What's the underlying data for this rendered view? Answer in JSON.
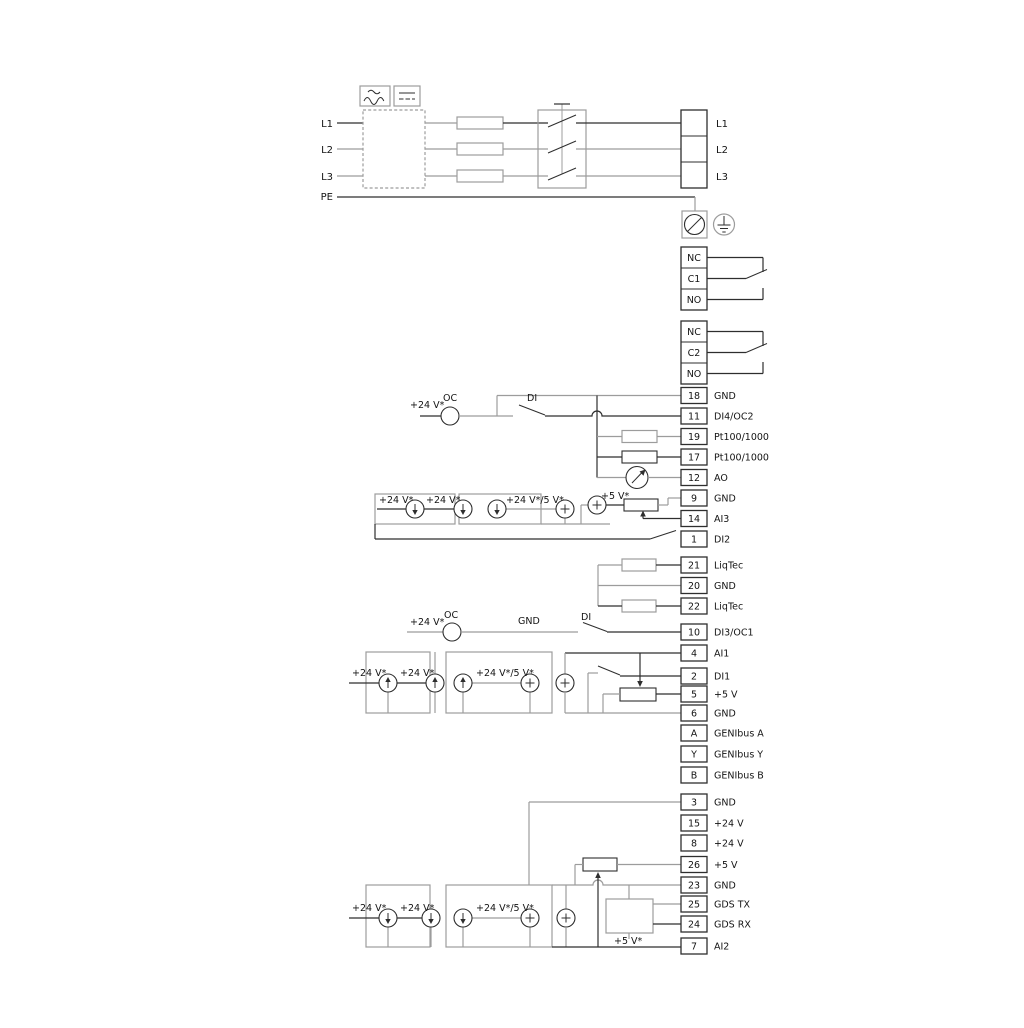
{
  "title": "Frequency converter power and control terminal wiring diagram",
  "colors": {
    "background": "#ffffff",
    "wire_dark": "#2e2e2e",
    "wire_gray": "#9c9c9c",
    "text": "#141414"
  },
  "power_in": {
    "l1": "L1",
    "l2": "L2",
    "l3": "L3",
    "pe": "PE"
  },
  "power_out": {
    "l1": "L1",
    "l2": "L2",
    "l3": "L3"
  },
  "relay1": {
    "nc": "NC",
    "c": "C1",
    "no": "NO"
  },
  "relay2": {
    "nc": "NC",
    "c": "C2",
    "no": "NO"
  },
  "rows": {
    "t18": {
      "n": "18",
      "l": "GND"
    },
    "t11": {
      "n": "11",
      "l": "DI4/OC2"
    },
    "t19": {
      "n": "19",
      "l": "Pt100/1000"
    },
    "t17": {
      "n": "17",
      "l": "Pt100/1000"
    },
    "t12": {
      "n": "12",
      "l": "AO"
    },
    "t9": {
      "n": "9",
      "l": "GND"
    },
    "t14": {
      "n": "14",
      "l": "AI3"
    },
    "t1": {
      "n": "1",
      "l": "DI2"
    },
    "t21": {
      "n": "21",
      "l": "LiqTec"
    },
    "t20": {
      "n": "20",
      "l": "GND"
    },
    "t22": {
      "n": "22",
      "l": "LiqTec"
    },
    "t10": {
      "n": "10",
      "l": "DI3/OC1"
    },
    "t4": {
      "n": "4",
      "l": "AI1"
    },
    "t2": {
      "n": "2",
      "l": "DI1"
    },
    "t5": {
      "n": "5",
      "l": "+5 V"
    },
    "t6": {
      "n": "6",
      "l": "GND"
    },
    "tA": {
      "n": "A",
      "l": "GENIbus A"
    },
    "tY": {
      "n": "Y",
      "l": "GENIbus Y"
    },
    "tB": {
      "n": "B",
      "l": "GENIbus B"
    },
    "t3": {
      "n": "3",
      "l": "GND"
    },
    "t15": {
      "n": "15",
      "l": "+24 V"
    },
    "t8": {
      "n": "8",
      "l": "+24 V"
    },
    "t26": {
      "n": "26",
      "l": "+5 V"
    },
    "t23": {
      "n": "23",
      "l": "GND"
    },
    "t25": {
      "n": "25",
      "l": "GDS TX"
    },
    "t24": {
      "n": "24",
      "l": "GDS RX"
    },
    "t7": {
      "n": "7",
      "l": "AI2"
    }
  },
  "ann": {
    "oc": "OC",
    "di": "DI",
    "gnd": "GND",
    "v24": "+24 V*",
    "v24or5": "+24 V*/5 V*",
    "v5": "+5 V*"
  }
}
